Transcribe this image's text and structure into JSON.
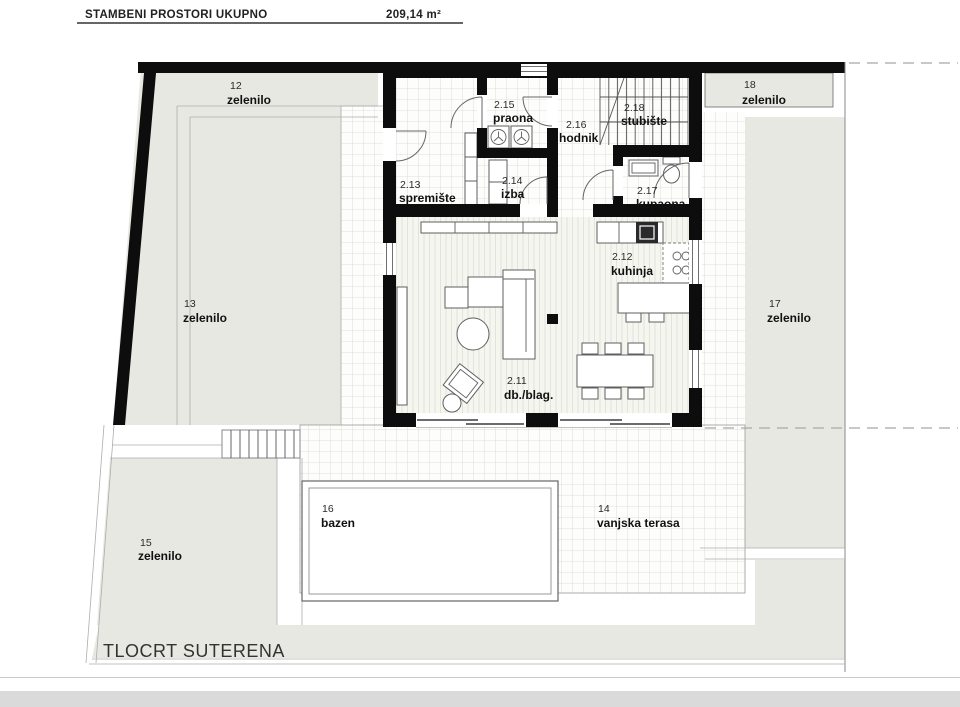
{
  "header": {
    "title": "STAMBENI PROSTORI UKUPNO",
    "total_area": "209,14 m²"
  },
  "footer": {
    "plan_title": "TLOCRT SUTERENA"
  },
  "rooms": {
    "r211": {
      "num": "2.11",
      "name": "db./blag."
    },
    "r212": {
      "num": "2.12",
      "name": "kuhinja"
    },
    "r213": {
      "num": "2.13",
      "name": "spremište"
    },
    "r214": {
      "num": "2.14",
      "name": "izba"
    },
    "r215": {
      "num": "2.15",
      "name": "praona"
    },
    "r216": {
      "num": "2.16",
      "name": "hodnik"
    },
    "r217": {
      "num": "2.17",
      "name": "kupaona"
    },
    "r218": {
      "num": "2.18",
      "name": "stubište"
    }
  },
  "outdoor": {
    "a12": {
      "num": "12",
      "name": "zelenilo"
    },
    "a13": {
      "num": "13",
      "name": "zelenilo"
    },
    "a14": {
      "num": "14",
      "name": "vanjska terasa"
    },
    "a15": {
      "num": "15",
      "name": "zelenilo"
    },
    "a16": {
      "num": "16",
      "name": "bazen"
    },
    "a17": {
      "num": "17",
      "name": "zelenilo"
    },
    "a18": {
      "num": "18",
      "name": "zelenilo"
    }
  },
  "colors": {
    "wall": "#0d0d0d",
    "greenery": "#e8e8e2",
    "floor": "#f6f6f1",
    "tile_line": "#d6d6d2",
    "hatch_line": "#e3e3da",
    "text": "#1a1a1a"
  }
}
